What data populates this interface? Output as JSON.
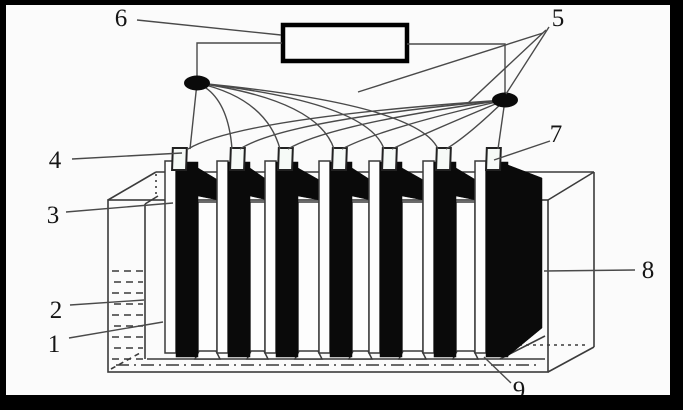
{
  "figure": {
    "description_visible": "",
    "colors": {
      "background": "#fbfbfb",
      "line_ink": "#3b3b3b",
      "electrode_fill": "#0a0a0a",
      "outer_frame": "#000000",
      "tab_fill": "#f6faf7"
    },
    "counts": {
      "numbered_labels": 9,
      "electrode_tabs": 7,
      "junction_dots": 2
    },
    "labels": [
      {
        "text": "1"
      },
      {
        "text": "2"
      },
      {
        "text": "3"
      },
      {
        "text": "4"
      },
      {
        "text": "5"
      },
      {
        "text": "6"
      },
      {
        "text": "7"
      },
      {
        "text": "8"
      },
      {
        "text": "9"
      }
    ]
  }
}
